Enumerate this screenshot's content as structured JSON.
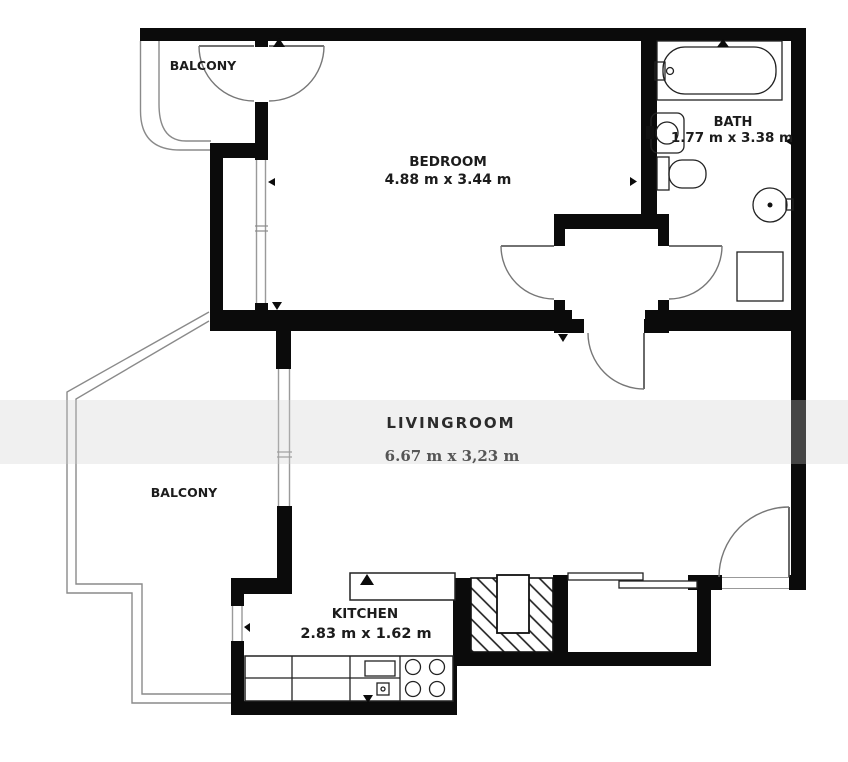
{
  "rooms": {
    "balcony_top": {
      "label": "BALCONY"
    },
    "bedroom": {
      "label": "BEDROOM",
      "dims": "4.88 m x 3.44 m"
    },
    "bath": {
      "label": "BATH",
      "dims": "1.77 m x 3.38 m"
    },
    "livingroom": {
      "label": "LIVINGROOM",
      "dims": "6.67 m x 3,23 m"
    },
    "balcony_left": {
      "label": "BALCONY"
    },
    "kitchen": {
      "label": "KITCHEN",
      "dims": "2.83 m x 1.62 m"
    }
  },
  "colors": {
    "wall": "#0b0b0b",
    "fixture": "#222222",
    "railing": "#8a8a8a",
    "doorline": "#777777",
    "label": "#1c1c1c",
    "living_dims": "#555555",
    "bg": "#ffffff"
  }
}
